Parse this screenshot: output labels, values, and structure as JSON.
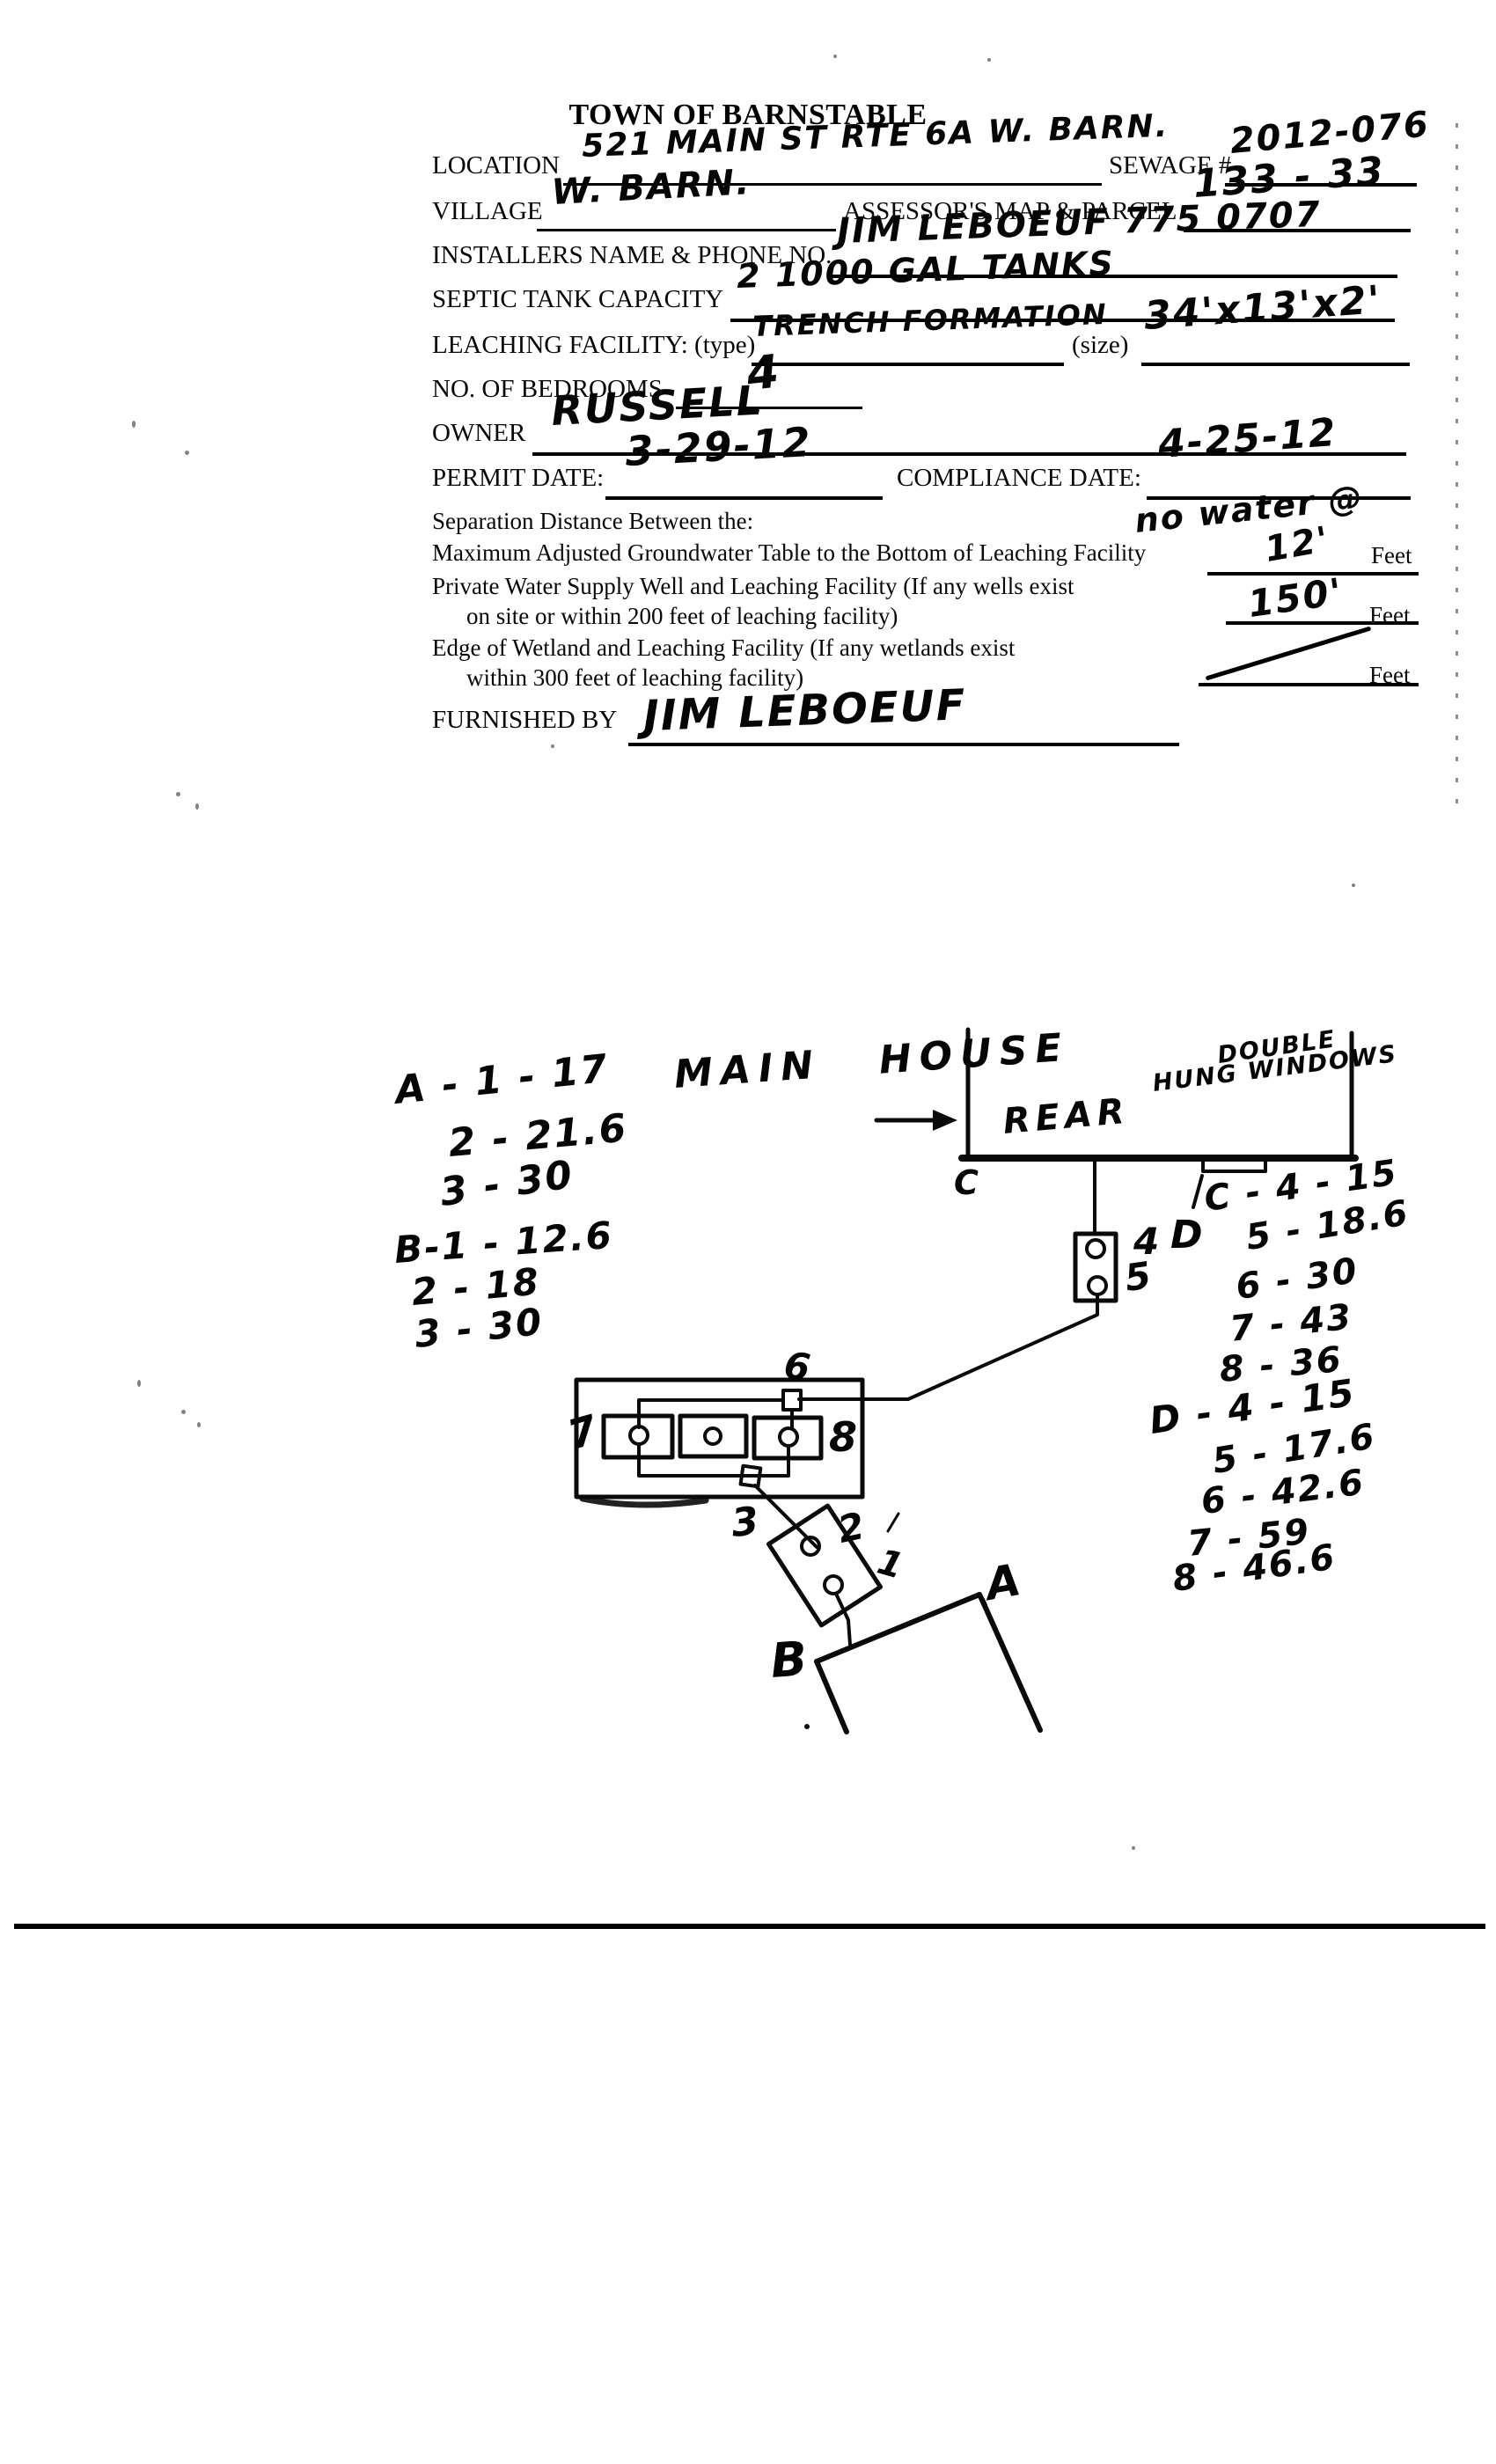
{
  "title": "TOWN OF BARNSTABLE",
  "form": {
    "location": {
      "label": "LOCATION",
      "value": "521 MAIN ST RTE 6A W. BARN."
    },
    "sewage": {
      "label": "SEWAGE #",
      "value": "2012-076"
    },
    "village": {
      "label": "VILLAGE",
      "value": "W. BARN."
    },
    "assessors": {
      "label": "ASSESSOR'S MAP & PARCEL",
      "value": "133 - 33"
    },
    "installer": {
      "label": "INSTALLERS NAME & PHONE NO.",
      "value": "JIM LEBOEUF 775 0707"
    },
    "septic": {
      "label": "SEPTIC TANK CAPACITY",
      "value": "2 1000 GAL TANKS"
    },
    "leaching": {
      "label": "LEACHING FACILITY: (type)",
      "type_value": "TRENCH FORMATION",
      "size_label": "(size)",
      "size_value": "34'x13'x2'"
    },
    "bedrooms": {
      "label": "NO. OF BEDROOMS",
      "value": "4"
    },
    "owner": {
      "label": "OWNER",
      "value": "RUSSELL"
    },
    "permit": {
      "label": "PERMIT DATE:",
      "value": "3-29-12"
    },
    "compliance": {
      "label": "COMPLIANCE DATE:",
      "value": "4-25-12"
    },
    "separation_heading": "Separation Distance Between the:",
    "no_water_note": "no water @",
    "groundwater": {
      "label": "Maximum Adjusted Groundwater Table to the Bottom of Leaching Facility",
      "value": "12'",
      "unit": "Feet"
    },
    "well": {
      "line1": "Private Water Supply Well and Leaching Facility (If any wells exist",
      "line2": "on site or within 200 feet of leaching facility)",
      "value": "150'",
      "unit": "Feet"
    },
    "wetland": {
      "line1": "Edge of Wetland and Leaching Facility (If any wetlands exist",
      "line2": "within 300 feet of leaching facility)",
      "unit": "Feet"
    },
    "furnished": {
      "label": "FURNISHED BY",
      "value": "JIM LEBOEUF"
    }
  },
  "diagram": {
    "main_house": "MAIN HOUSE",
    "rear": "REAR",
    "windows1": "DOUBLE",
    "windows2": "HUNG WINDOWS",
    "labels": {
      "a": "A",
      "b": "B",
      "c": "C",
      "d": "D",
      "n1": "1",
      "n2": "2",
      "n3": "3",
      "n4": "4",
      "n5": "5",
      "n6": "6",
      "n7": "7",
      "n8": "8"
    },
    "list_a": [
      "A - 1 - 17",
      "2 - 21.6",
      "3 - 30"
    ],
    "list_b": [
      "B-1 - 12.6",
      "2 - 18",
      "3 - 30"
    ],
    "list_c": [
      "C - 4 - 15",
      "5 - 18.6",
      "6 - 30",
      "7 - 43",
      "8 - 36"
    ],
    "list_d": [
      "D - 4 - 15",
      "5 - 17.6",
      "6 - 42.6",
      "7 - 59",
      "8 - 46.6"
    ]
  }
}
